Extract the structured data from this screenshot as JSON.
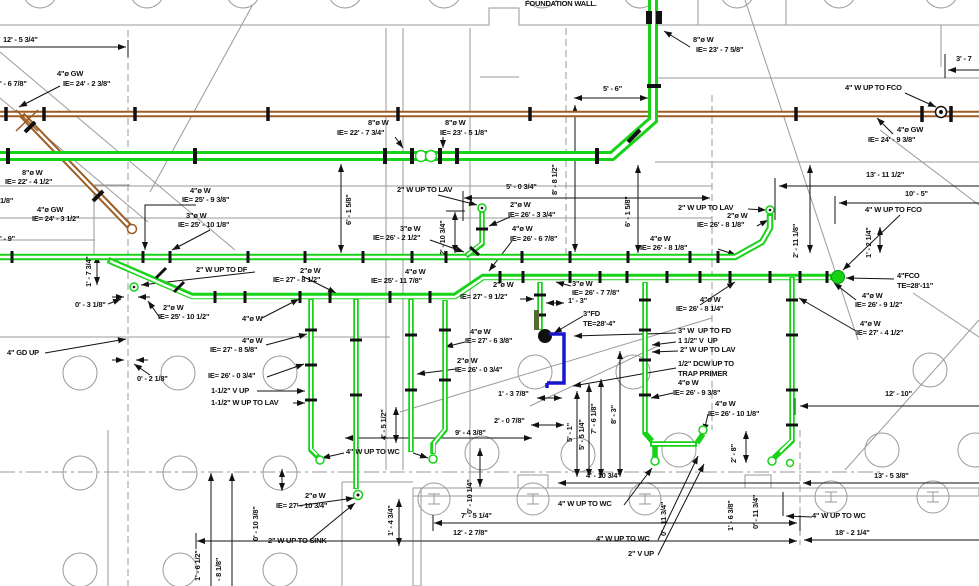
{
  "drawing": {
    "kind": "underground-plumbing-waste-piping-plan",
    "wall_note": "FOUNDATION WALL."
  },
  "colors": {
    "waste_green": "#17d317",
    "grease_brown": "#9c5c24",
    "trap_blue": "#1717cb",
    "structure_grey": "#9a9a9a",
    "annotation_black": "#111111"
  },
  "labels": [
    {
      "t": "12' - 5 3/4\"",
      "x": 3,
      "y": 36
    },
    {
      "t": "' - 6 7/8\"",
      "x": 0,
      "y": 80
    },
    {
      "t": "4\"ø GW",
      "x": 57,
      "y": 70
    },
    {
      "t": "IE= 24' - 2 3/8\"",
      "x": 63,
      "y": 80
    },
    {
      "t": "FOUNDATION WALL.",
      "x": 525,
      "y": 0,
      "n": "foundation-wall-note"
    },
    {
      "t": "8\"ø W",
      "x": 693,
      "y": 36
    },
    {
      "t": "IE= 23' - 7 5/8\"",
      "x": 696,
      "y": 46
    },
    {
      "t": "4\" W UP TO FCO",
      "x": 845,
      "y": 84
    },
    {
      "t": "3' - 7",
      "x": 956,
      "y": 55
    },
    {
      "t": "8\"ø W",
      "x": 368,
      "y": 119
    },
    {
      "t": "IE= 22' - 7 3/4\"",
      "x": 337,
      "y": 129
    },
    {
      "t": "8\"ø W",
      "x": 445,
      "y": 119
    },
    {
      "t": "IE= 23' - 5 1/8\"",
      "x": 440,
      "y": 129
    },
    {
      "t": "5' - 6\"",
      "x": 603,
      "y": 85
    },
    {
      "t": "4\"ø GW",
      "x": 897,
      "y": 126
    },
    {
      "t": "IE= 24' - 9 3/8\"",
      "x": 868,
      "y": 136
    },
    {
      "t": "13' - 11 1/2\"",
      "x": 866,
      "y": 171
    },
    {
      "t": "10' - 5\"",
      "x": 905,
      "y": 190
    },
    {
      "t": "8\"ø W",
      "x": 22,
      "y": 169
    },
    {
      "t": "IE= 22' - 4 1/2\"",
      "x": 5,
      "y": 178
    },
    {
      "t": "1/8\"",
      "x": 0,
      "y": 197
    },
    {
      "t": "4\"ø GW",
      "x": 37,
      "y": 206
    },
    {
      "t": "IE= 24' - 3 1/2\"",
      "x": 32,
      "y": 215
    },
    {
      "t": "' - 9\"",
      "x": 0,
      "y": 235
    },
    {
      "t": "4\"ø W",
      "x": 190,
      "y": 187
    },
    {
      "t": "IE= 25' - 9 3/8\"",
      "x": 182,
      "y": 196
    },
    {
      "t": "3\"ø W",
      "x": 186,
      "y": 212
    },
    {
      "t": "IE= 25' - 10 1/8\"",
      "x": 178,
      "y": 221
    },
    {
      "t": "2\" W UP TO LAV",
      "x": 397,
      "y": 186
    },
    {
      "t": "5' - 0 3/4\"",
      "x": 506,
      "y": 183
    },
    {
      "t": "2\"ø W",
      "x": 510,
      "y": 201
    },
    {
      "t": "IE= 26' - 3 3/4\"",
      "x": 508,
      "y": 211
    },
    {
      "t": "3\"ø W",
      "x": 400,
      "y": 225
    },
    {
      "t": "IE= 26' - 2 1/2\"",
      "x": 373,
      "y": 234
    },
    {
      "t": "4\"ø W",
      "x": 512,
      "y": 225
    },
    {
      "t": "IE= 26' - 6 7/8\"",
      "x": 510,
      "y": 235
    },
    {
      "t": "2\" W UP TO LAV",
      "x": 678,
      "y": 204
    },
    {
      "t": "2\"ø W",
      "x": 727,
      "y": 212
    },
    {
      "t": "IE= 26' - 8 1/8\"",
      "x": 697,
      "y": 221
    },
    {
      "t": "4\"ø W",
      "x": 650,
      "y": 235
    },
    {
      "t": "IE= 26' - 8 1/8\"",
      "x": 640,
      "y": 244
    },
    {
      "t": "4\" W UP TO FCO",
      "x": 865,
      "y": 206
    },
    {
      "t": "4\"FCO",
      "x": 897,
      "y": 272
    },
    {
      "t": "TE=28'-11\"",
      "x": 897,
      "y": 282
    },
    {
      "t": "4\"ø W",
      "x": 862,
      "y": 292
    },
    {
      "t": "IE= 26' - 9 1/2\"",
      "x": 855,
      "y": 301
    },
    {
      "t": "4\"ø W",
      "x": 860,
      "y": 320
    },
    {
      "t": "IE= 27' - 4 1/2\"",
      "x": 856,
      "y": 329
    },
    {
      "t": "2\" W UP TO DF",
      "x": 196,
      "y": 266
    },
    {
      "t": "2\"ø W",
      "x": 300,
      "y": 267
    },
    {
      "t": "IE= 27' - 8 1/2\"",
      "x": 273,
      "y": 276
    },
    {
      "t": "0' - 3 1/8\"",
      "x": 75,
      "y": 301
    },
    {
      "t": "2\"ø W",
      "x": 163,
      "y": 304
    },
    {
      "t": "IE= 25' - 10 1/2\"",
      "x": 158,
      "y": 313
    },
    {
      "t": "4\"ø W",
      "x": 242,
      "y": 315
    },
    {
      "t": "4\"ø W",
      "x": 405,
      "y": 268
    },
    {
      "t": "IE= 25' - 11 7/8\"",
      "x": 371,
      "y": 277
    },
    {
      "t": "2\"ø W",
      "x": 493,
      "y": 281
    },
    {
      "t": "IE= 27' - 9 1/2\"",
      "x": 460,
      "y": 293
    },
    {
      "t": "3\"ø W",
      "x": 572,
      "y": 280
    },
    {
      "t": "IE= 26' - 7 7/8\"",
      "x": 572,
      "y": 289
    },
    {
      "t": "1' - 3\"",
      "x": 568,
      "y": 297
    },
    {
      "t": "3\"FD",
      "x": 583,
      "y": 310
    },
    {
      "t": "TE=28'-4\"",
      "x": 583,
      "y": 320
    },
    {
      "t": "4\"ø W",
      "x": 242,
      "y": 337
    },
    {
      "t": "IE= 27' - 8 5/8\"",
      "x": 210,
      "y": 346
    },
    {
      "t": "4\" GD UP",
      "x": 7,
      "y": 349
    },
    {
      "t": "0' - 2 1/8\"",
      "x": 137,
      "y": 375
    },
    {
      "t": "IE= 26' - 0 3/4\"",
      "x": 208,
      "y": 372
    },
    {
      "t": "1-1/2\" V UP",
      "x": 211,
      "y": 387
    },
    {
      "t": "1-1/2\" W UP TO LAV",
      "x": 211,
      "y": 399
    },
    {
      "t": "4\"ø W",
      "x": 470,
      "y": 328
    },
    {
      "t": "IE= 27' - 6 3/8\"",
      "x": 465,
      "y": 337
    },
    {
      "t": "2\"ø W",
      "x": 457,
      "y": 357
    },
    {
      "t": "IE= 26' - 0 3/4\"",
      "x": 455,
      "y": 366
    },
    {
      "t": "4\"ø W",
      "x": 700,
      "y": 296
    },
    {
      "t": "IE= 26' - 8 1/4\"",
      "x": 676,
      "y": 305
    },
    {
      "t": "4\"ø W",
      "x": 857,
      "y": 294,
      "n": "hidden"
    },
    {
      "t": "3\" W  UP TO FD",
      "x": 678,
      "y": 327
    },
    {
      "t": "1 1/2\" V  UP",
      "x": 678,
      "y": 337
    },
    {
      "t": "2\" W UP TO LAV",
      "x": 680,
      "y": 346
    },
    {
      "t": "1/2\" DCW UP TO",
      "x": 678,
      "y": 360
    },
    {
      "t": "TRAP PRIMER",
      "x": 678,
      "y": 370
    },
    {
      "t": "4\"ø W",
      "x": 678,
      "y": 379
    },
    {
      "t": "IE= 26' - 9 3/8\"",
      "x": 673,
      "y": 389
    },
    {
      "t": "4\"ø W",
      "x": 715,
      "y": 400
    },
    {
      "t": "IE= 26' - 10 1/8\"",
      "x": 708,
      "y": 410
    },
    {
      "t": "12' - 10\"",
      "x": 885,
      "y": 390
    },
    {
      "t": "1' - 3 7/8\"",
      "x": 498,
      "y": 390
    },
    {
      "t": "2' - 0 7/8\"",
      "x": 494,
      "y": 417
    },
    {
      "t": "9' - 4 3/8\"",
      "x": 455,
      "y": 429
    },
    {
      "t": "4\" W UP TO WC",
      "x": 346,
      "y": 448
    },
    {
      "t": "4' - 10 3/4\"",
      "x": 586,
      "y": 472
    },
    {
      "t": "13' - 5 3/8\"",
      "x": 874,
      "y": 472
    },
    {
      "t": "4\" W UP TO WC",
      "x": 812,
      "y": 512
    },
    {
      "t": "18' - 2 1/4\"",
      "x": 835,
      "y": 529
    },
    {
      "t": "2\"ø W",
      "x": 305,
      "y": 492
    },
    {
      "t": "IE= 27' - 10 3/4\"",
      "x": 276,
      "y": 502
    },
    {
      "t": "2\" W UP TO SINK",
      "x": 268,
      "y": 537
    },
    {
      "t": "7' - 5 1/4\"",
      "x": 461,
      "y": 512
    },
    {
      "t": "12' - 2 7/8\"",
      "x": 453,
      "y": 529
    },
    {
      "t": "4\" W UP TO WC",
      "x": 558,
      "y": 500
    },
    {
      "t": "4\" W UP TO WC",
      "x": 596,
      "y": 535
    },
    {
      "t": "2\" V UP",
      "x": 628,
      "y": 550
    },
    {
      "t": "6' - 1 5/8\"",
      "x": 345,
      "y": 225,
      "r": 1
    },
    {
      "t": "6' - 1 5/8\"",
      "x": 624,
      "y": 227,
      "r": 1
    },
    {
      "t": "8' - 8 1/2\"",
      "x": 551,
      "y": 195,
      "r": 1
    },
    {
      "t": "2' - 10 3/4\"",
      "x": 439,
      "y": 255,
      "r": 1
    },
    {
      "t": "2' - 11 1/8\"",
      "x": 792,
      "y": 258,
      "r": 1
    },
    {
      "t": "1' - 2 1/4\"",
      "x": 865,
      "y": 258,
      "r": 1
    },
    {
      "t": "1' - 7 3/4\"",
      "x": 85,
      "y": 287,
      "r": 1
    },
    {
      "t": "4' - 5 1/2\"",
      "x": 380,
      "y": 440,
      "r": 1
    },
    {
      "t": "5' - 1\"",
      "x": 566,
      "y": 442,
      "r": 1
    },
    {
      "t": "5' - 5 1/4\"",
      "x": 578,
      "y": 450,
      "r": 1
    },
    {
      "t": "7' - 6 1/8\"",
      "x": 590,
      "y": 434,
      "r": 1
    },
    {
      "t": "8' - 3\"",
      "x": 610,
      "y": 424,
      "r": 1
    },
    {
      "t": "2' - 8\"",
      "x": 730,
      "y": 463,
      "r": 1
    },
    {
      "t": "0' - 10 1/4\"",
      "x": 466,
      "y": 514,
      "r": 1
    },
    {
      "t": "0' - 11 3/4\"",
      "x": 660,
      "y": 536,
      "r": 1
    },
    {
      "t": "1' - 6 3/8\"",
      "x": 727,
      "y": 531,
      "r": 1
    },
    {
      "t": "0' - 11 3/4\"",
      "x": 752,
      "y": 529,
      "r": 1
    },
    {
      "t": "0' - 10 3/8\"",
      "x": 252,
      "y": 541,
      "r": 1
    },
    {
      "t": "1' - 4 3/4\"",
      "x": 387,
      "y": 536,
      "r": 1
    },
    {
      "t": "1' - 6 1/2\"",
      "x": 194,
      "y": 581,
      "r": 1
    },
    {
      "t": "- 8 1/8\"",
      "x": 215,
      "y": 581,
      "r": 1
    }
  ]
}
